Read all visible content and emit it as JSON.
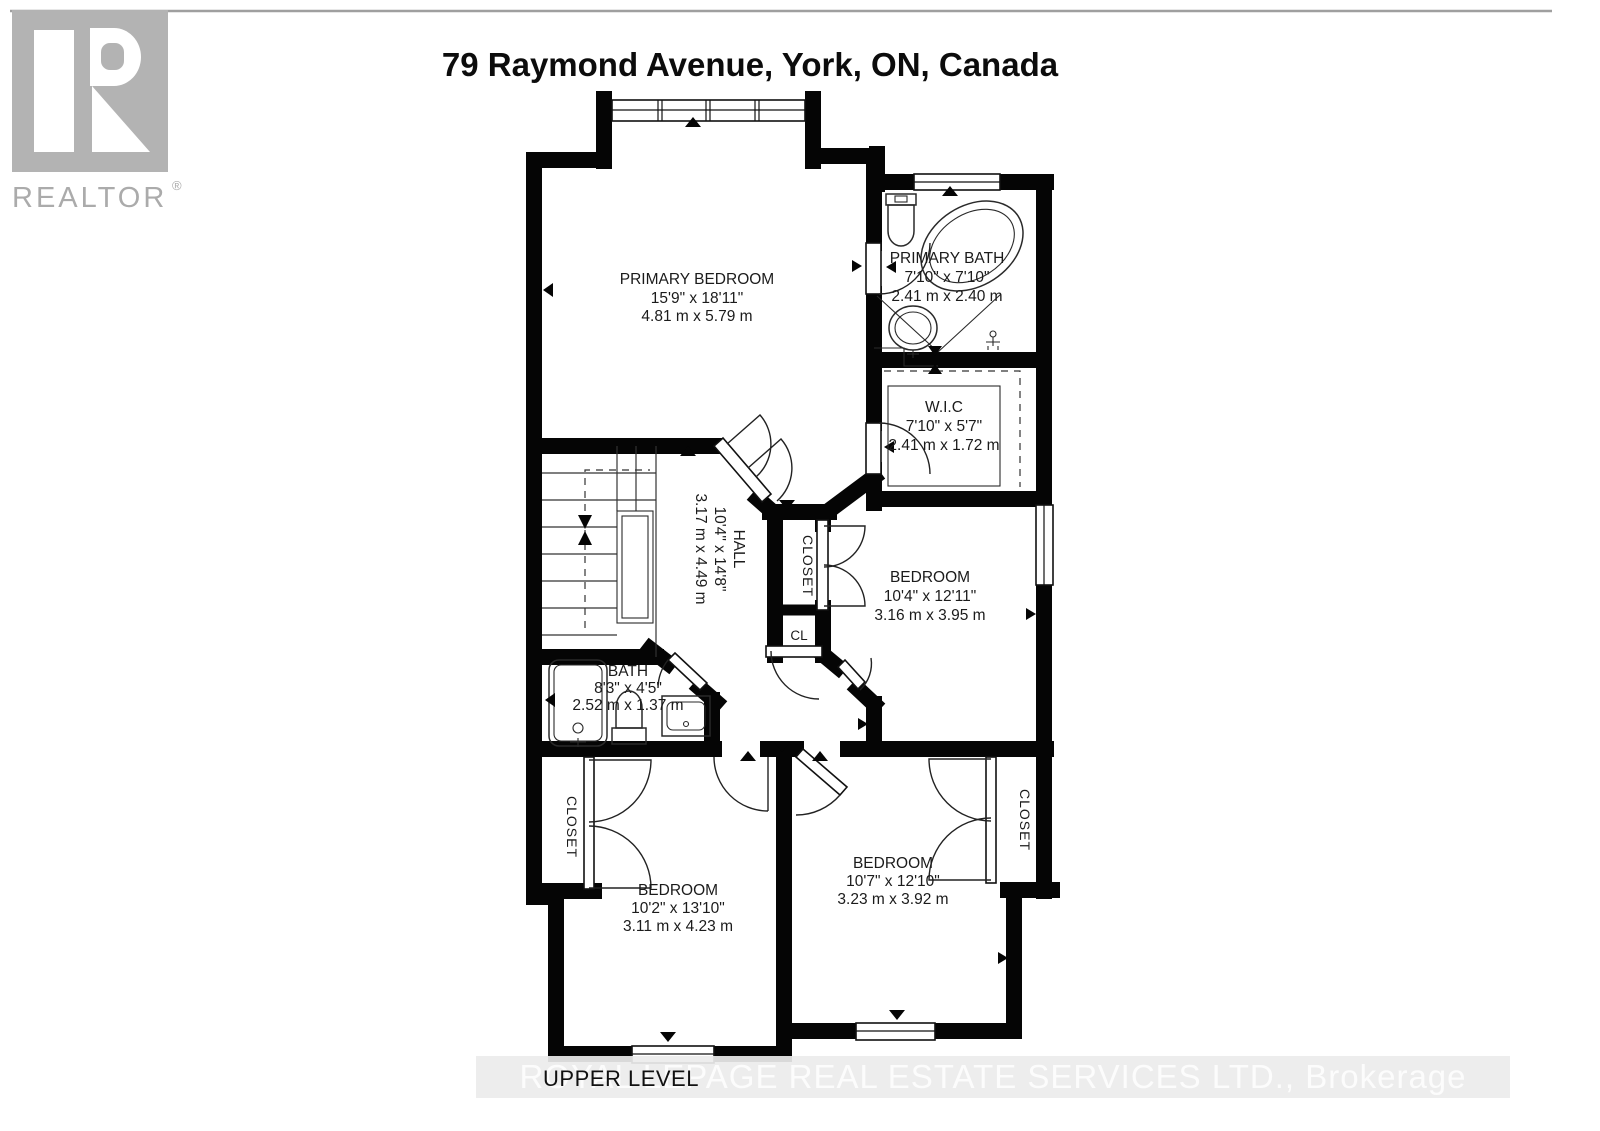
{
  "header": {
    "title": "79 Raymond Avenue, York, ON, Canada"
  },
  "logo": {
    "brand": "REALTOR",
    "registered_mark": "®"
  },
  "plan": {
    "rooms": [
      {
        "id": "primary_bedroom",
        "name": "PRIMARY BEDROOM",
        "imperial": "15'9\" x 18'11\"",
        "metric": "4.81 m x 5.79 m"
      },
      {
        "id": "primary_bath",
        "name": "PRIMARY BATH",
        "imperial": "7'10\" x 7'10\"",
        "metric": "2.41 m x 2.40 m"
      },
      {
        "id": "wic",
        "name": "W.I.C",
        "imperial": "7'10\" x 5'7\"",
        "metric": "2.41 m x 1.72 m"
      },
      {
        "id": "hall",
        "name": "HALL",
        "imperial": "10'4\" x 14'8\"",
        "metric": "3.17 m x 4.49 m"
      },
      {
        "id": "bedroom_middle",
        "name": "BEDROOM",
        "imperial": "10'4\" x 12'11\"",
        "metric": "3.16 m x 3.95 m"
      },
      {
        "id": "bath",
        "name": "BATH",
        "imperial": "8'3\" x 4'5\"",
        "metric": "2.52 m x 1.37 m"
      },
      {
        "id": "bedroom_left",
        "name": "BEDROOM",
        "imperial": "10'2\" x 13'10\"",
        "metric": "3.11 m x 4.23 m"
      },
      {
        "id": "bedroom_right",
        "name": "BEDROOM",
        "imperial": "10'7\" x 12'10\"",
        "metric": "3.23 m x 3.92 m"
      }
    ],
    "labels": {
      "closet": "CLOSET",
      "closet_small": "CL"
    }
  },
  "footer": {
    "level_label": "UPPER LEVEL",
    "watermark": "ROYAL LEPAGE REAL ESTATE SERVICES LTD., Brokerage"
  },
  "colors": {
    "walls": "#050505",
    "logo_gray": "#b3b3b3",
    "watermark_band": "#ececec",
    "background": "#ffffff"
  }
}
